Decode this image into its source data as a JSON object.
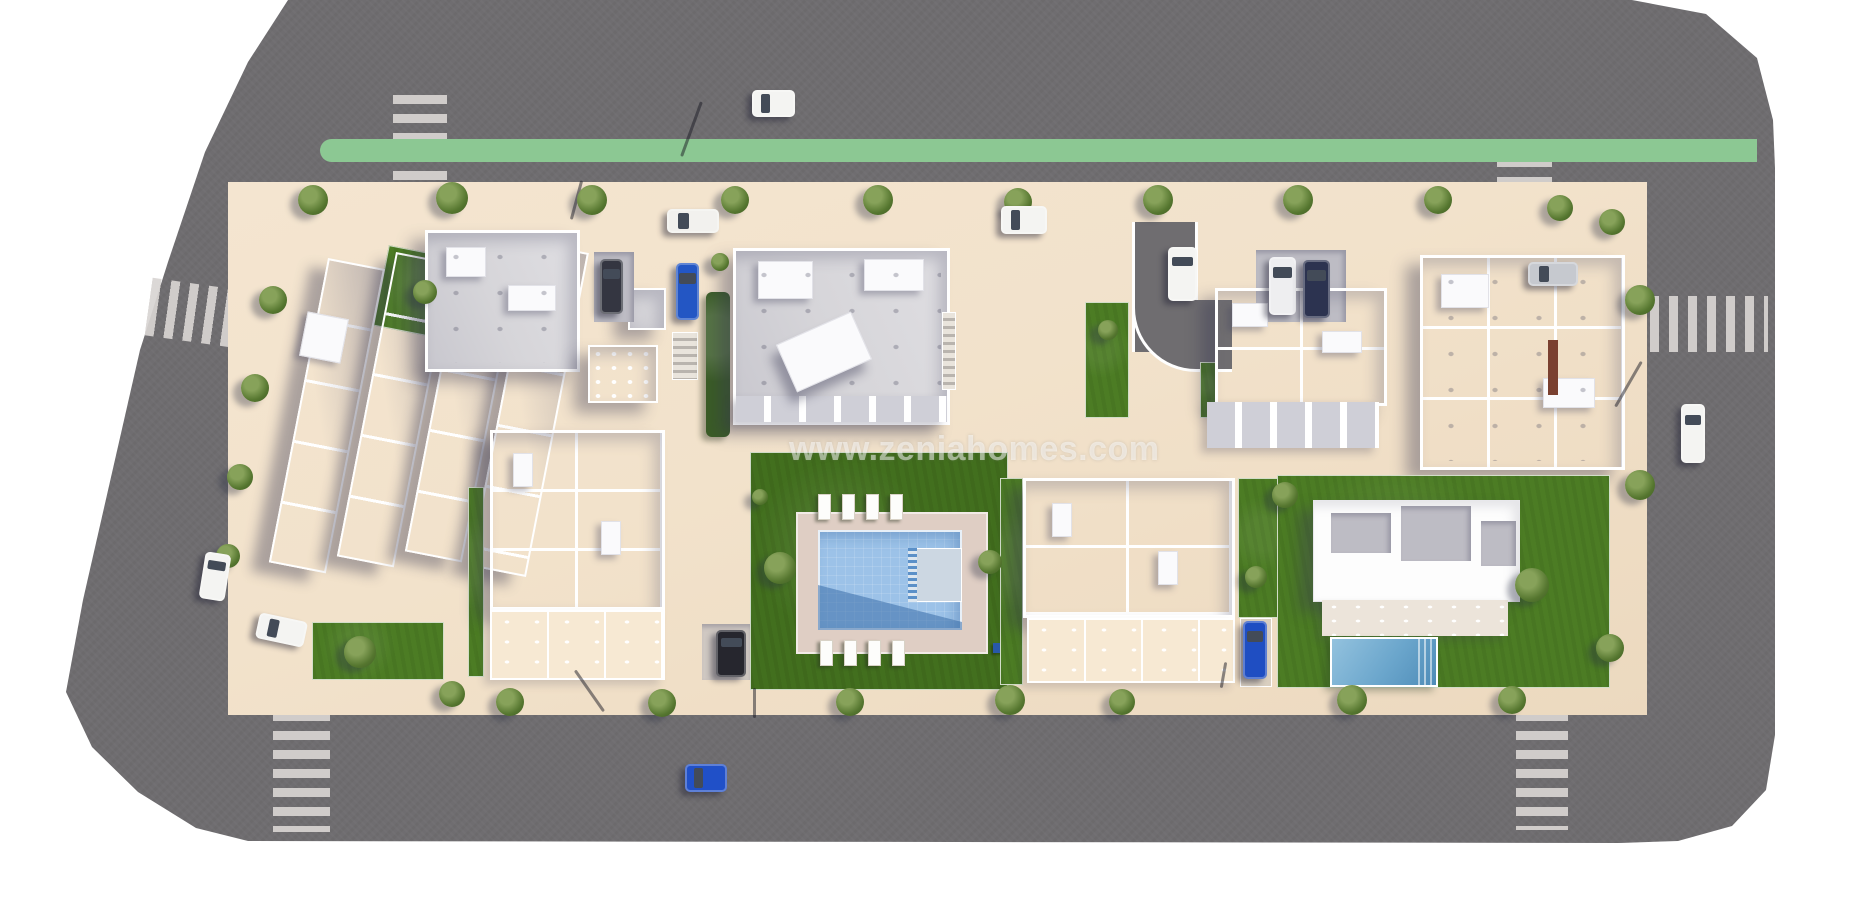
{
  "watermark": {
    "text": "www.zeniahomes.com"
  },
  "scene": {
    "description": "aerial-3d-site-plan-render-of-residential-development",
    "colors": {
      "background": "#ffffff",
      "road_asphalt": "#6f6d70",
      "sidewalk": "#b7b1ae",
      "block_courtyard": "#f2e2cb",
      "building_roof": "#d6d5d9",
      "building_wall": "#ffffff",
      "lawn": "#4c7c24",
      "bike_lane": "#8cc893",
      "communal_pool": "#9cc2e8",
      "villa_pool": "#5f9cc4",
      "crosswalk_stripe": "#d8d4d2",
      "pool_deck": "#dfcec4"
    },
    "roads": [
      "north-road",
      "west-road-diagonal",
      "south-road",
      "east-road"
    ],
    "bike_lane": {
      "road": "north-road",
      "color": "#8cc893"
    },
    "buildings": [
      "townhouse-rows-cluster-west",
      "apartment-a-north",
      "apartment-b-north-center",
      "apartment-c-north-east",
      "apartment-d-north-far-east",
      "townhouse-row-south-west",
      "townhouse-row-south-east",
      "villa-south-east"
    ],
    "amenities": [
      "communal-pool",
      "communal-garden",
      "villa-pool",
      "curved-driveway"
    ],
    "sun_loungers": {
      "top_row": 4,
      "bottom_row": 4
    },
    "crosswalks": [
      {
        "id": "crosswalk-north-west",
        "x": 393,
        "y": 95,
        "w": 54,
        "h": 110,
        "dir": "h",
        "rot": 0
      },
      {
        "id": "crosswalk-north-east",
        "x": 1497,
        "y": 158,
        "w": 55,
        "h": 50,
        "dir": "h",
        "rot": 0
      },
      {
        "id": "crosswalk-west",
        "x": 148,
        "y": 286,
        "w": 122,
        "h": 58,
        "dir": "v",
        "rot": 8
      },
      {
        "id": "crosswalk-south-west",
        "x": 273,
        "y": 712,
        "w": 57,
        "h": 120,
        "dir": "h",
        "rot": 0
      },
      {
        "id": "crosswalk-south-east",
        "x": 1516,
        "y": 712,
        "w": 52,
        "h": 118,
        "dir": "h",
        "rot": 0
      },
      {
        "id": "crosswalk-east",
        "x": 1650,
        "y": 296,
        "w": 118,
        "h": 56,
        "dir": "v",
        "rot": 0
      }
    ],
    "cars": [
      {
        "id": "car-white-north-upper-lane",
        "color": "#f4f4f2",
        "x": 752,
        "y": 90,
        "w": 43,
        "h": 27,
        "rot": 0
      },
      {
        "id": "car-white-convertible-north-lower",
        "color": "#f2f1ee",
        "x": 667,
        "y": 209,
        "w": 52,
        "h": 24,
        "rot": 0
      },
      {
        "id": "car-white-north-lower-2",
        "color": "#f4f4f2",
        "x": 1001,
        "y": 206,
        "w": 46,
        "h": 28,
        "rot": 0
      },
      {
        "id": "car-white-east-road",
        "color": "#f4f4f2",
        "x": 1681,
        "y": 404,
        "w": 24,
        "h": 59,
        "rot": 0
      },
      {
        "id": "car-white-west-road",
        "color": "#f4f4f2",
        "x": 202,
        "y": 553,
        "w": 26,
        "h": 47,
        "rot": 9
      },
      {
        "id": "car-blue-south-road",
        "color": "#2050c8",
        "x": 685,
        "y": 764,
        "w": 42,
        "h": 28,
        "rot": 0
      },
      {
        "id": "car-white-parked-cluster",
        "color": "#f4f4f2",
        "x": 257,
        "y": 617,
        "w": 49,
        "h": 26,
        "rot": 12
      },
      {
        "id": "van-dark-parked-a",
        "color": "#343641",
        "x": 600,
        "y": 259,
        "w": 23,
        "h": 55,
        "rot": 0
      },
      {
        "id": "car-blue-parked-a",
        "color": "#2356c4",
        "x": 676,
        "y": 263,
        "w": 23,
        "h": 57,
        "rot": 0
      },
      {
        "id": "car-white-driveway",
        "color": "#f4f4f2",
        "x": 1168,
        "y": 247,
        "w": 29,
        "h": 54,
        "rot": 0
      },
      {
        "id": "van-white-parked-c",
        "color": "#eeeef0",
        "x": 1269,
        "y": 257,
        "w": 27,
        "h": 58,
        "rot": 0
      },
      {
        "id": "van-navy-parked-c",
        "color": "#2c3350",
        "x": 1303,
        "y": 260,
        "w": 27,
        "h": 58,
        "rot": 0
      },
      {
        "id": "car-dark-parked-south",
        "color": "#26262e",
        "x": 716,
        "y": 630,
        "w": 30,
        "h": 47,
        "rot": 0
      },
      {
        "id": "car-blue-parked-villa-side",
        "color": "#1f4ec2",
        "x": 1243,
        "y": 621,
        "w": 24,
        "h": 58,
        "rot": 0
      },
      {
        "id": "car-silver-at-d",
        "color": "#c6c9cf",
        "x": 1528,
        "y": 262,
        "w": 50,
        "h": 24,
        "rot": 0
      }
    ],
    "trees": [
      {
        "x": 313,
        "y": 200,
        "r": 15
      },
      {
        "x": 452,
        "y": 198,
        "r": 16
      },
      {
        "x": 592,
        "y": 200,
        "r": 15
      },
      {
        "x": 735,
        "y": 200,
        "r": 14
      },
      {
        "x": 878,
        "y": 200,
        "r": 15
      },
      {
        "x": 1018,
        "y": 202,
        "r": 14
      },
      {
        "x": 1158,
        "y": 200,
        "r": 15
      },
      {
        "x": 1298,
        "y": 200,
        "r": 15
      },
      {
        "x": 1438,
        "y": 200,
        "r": 14
      },
      {
        "x": 1560,
        "y": 208,
        "r": 13
      },
      {
        "x": 1612,
        "y": 222,
        "r": 13
      },
      {
        "x": 1640,
        "y": 300,
        "r": 15
      },
      {
        "x": 1640,
        "y": 485,
        "r": 15
      },
      {
        "x": 1610,
        "y": 648,
        "r": 14
      },
      {
        "x": 510,
        "y": 702,
        "r": 14
      },
      {
        "x": 662,
        "y": 703,
        "r": 14
      },
      {
        "x": 850,
        "y": 702,
        "r": 14
      },
      {
        "x": 1010,
        "y": 700,
        "r": 15
      },
      {
        "x": 1122,
        "y": 702,
        "r": 13
      },
      {
        "x": 1352,
        "y": 700,
        "r": 15
      },
      {
        "x": 1512,
        "y": 700,
        "r": 14
      },
      {
        "x": 452,
        "y": 694,
        "r": 13
      },
      {
        "x": 273,
        "y": 300,
        "r": 14
      },
      {
        "x": 255,
        "y": 388,
        "r": 14
      },
      {
        "x": 240,
        "y": 477,
        "r": 13
      },
      {
        "x": 228,
        "y": 556,
        "r": 12
      },
      {
        "x": 360,
        "y": 652,
        "r": 16
      },
      {
        "x": 425,
        "y": 292,
        "r": 12
      },
      {
        "x": 780,
        "y": 568,
        "r": 16
      },
      {
        "x": 760,
        "y": 497,
        "r": 8
      },
      {
        "x": 990,
        "y": 562,
        "r": 12
      },
      {
        "x": 1532,
        "y": 585,
        "r": 17
      },
      {
        "x": 1285,
        "y": 495,
        "r": 13
      },
      {
        "x": 1256,
        "y": 577,
        "r": 11
      },
      {
        "x": 720,
        "y": 262,
        "r": 9
      },
      {
        "x": 1108,
        "y": 330,
        "r": 10
      }
    ],
    "lamps": [
      {
        "x": 690,
        "y": 100,
        "len": 58,
        "rot": 20
      },
      {
        "x": 575,
        "y": 180,
        "len": 40,
        "rot": 15
      },
      {
        "x": 1627,
        "y": 358,
        "len": 52,
        "rot": 30
      },
      {
        "x": 588,
        "y": 666,
        "len": 50,
        "rot": -35
      },
      {
        "x": 753,
        "y": 688,
        "len": 30,
        "rot": 0
      },
      {
        "x": 1222,
        "y": 662,
        "len": 26,
        "rot": 10
      }
    ],
    "bike_lane_marks": [
      {
        "x": 429,
        "y": 249
      },
      {
        "x": 432,
        "y": 274
      }
    ]
  }
}
